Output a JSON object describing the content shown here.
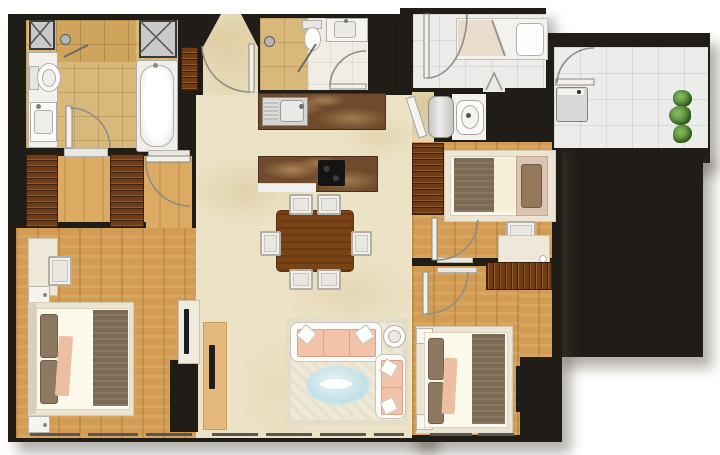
{
  "meta": {
    "type": "apartment-floor-plan",
    "description": "Top-down rendered color floor plan of a three-bedroom apartment with living-dining area, kitchen, two bathrooms, utility WC and balcony",
    "width_px": 720,
    "height_px": 455,
    "visible_text": "none"
  },
  "palette": {
    "background": "#ffffff",
    "wall": "#201c17",
    "marble_floor": "#ece3c7",
    "wood_floor": "#d29c54",
    "wood_floor_light": "#dcab63",
    "bathroom_tile_tan": "#d9b87c",
    "counter_brown_marble": "#6f4a2c",
    "wardrobe_dark_wood": "#6e3c18",
    "white_tile": "#ececea",
    "sofa_peach": "#f2c3a8",
    "coffee_table_glass_blue": "#cfe8ec",
    "blanket_brown": "#7b6a54",
    "plant_green": "#447a2b"
  },
  "rooms": [
    {
      "id": "master-bathroom",
      "position": "top-left",
      "floor": "tan tile",
      "items": [
        "service-shaft",
        "service-shaft",
        "shower-head",
        "glass-shower-partition",
        "toilet",
        "vanity-sink",
        "bathtub",
        "door"
      ]
    },
    {
      "id": "walk-in-closet",
      "position": "left",
      "floor": "light wood",
      "items": [
        "wardrobe",
        "wardrobe",
        "door"
      ]
    },
    {
      "id": "master-bedroom",
      "position": "bottom-left",
      "floor": "wood",
      "items": [
        "desk",
        "desk-chair",
        "nightstand",
        "double-bed",
        "nightstand",
        "tv-console",
        "tv"
      ]
    },
    {
      "id": "living-dining",
      "position": "center",
      "floor": "cream marble",
      "items": [
        "dining-table",
        "dining-chair x6",
        "rug",
        "three-seat-sofa",
        "two-seat-sofa",
        "round-side-table",
        "oval-glass-coffee-table",
        "tv-cabinet",
        "tv",
        "foyer-cabinet",
        "entrance-door"
      ]
    },
    {
      "id": "kitchen",
      "position": "center",
      "floor": "cream marble",
      "items": [
        "counter-with-sink",
        "island-with-cooktop"
      ]
    },
    {
      "id": "bathroom-2",
      "position": "top-center",
      "floor": "tan tile + white marble",
      "items": [
        "shower-head",
        "glass-partition",
        "toilet",
        "vanity-sink",
        "door"
      ]
    },
    {
      "id": "entry-hall",
      "position": "top-right-center",
      "floor": "white tile",
      "items": [
        "entrance-door",
        "shower-room",
        "bifold-door"
      ]
    },
    {
      "id": "utility-wc",
      "position": "right-center",
      "floor": "white tile",
      "items": [
        "water-heater",
        "toilet"
      ]
    },
    {
      "id": "balcony",
      "position": "top-right",
      "floor": "white tile",
      "items": [
        "door",
        "washing-machine",
        "plant",
        "plant",
        "plant"
      ]
    },
    {
      "id": "bedroom-2",
      "position": "right",
      "floor": "wood",
      "items": [
        "wardrobe",
        "single-bed",
        "desk-chair",
        "desk",
        "wardrobe",
        "door"
      ]
    },
    {
      "id": "bedroom-3",
      "position": "bottom-right",
      "floor": "wood",
      "items": [
        "nightstand",
        "double-bed",
        "nightstand",
        "tv",
        "door"
      ]
    }
  ]
}
